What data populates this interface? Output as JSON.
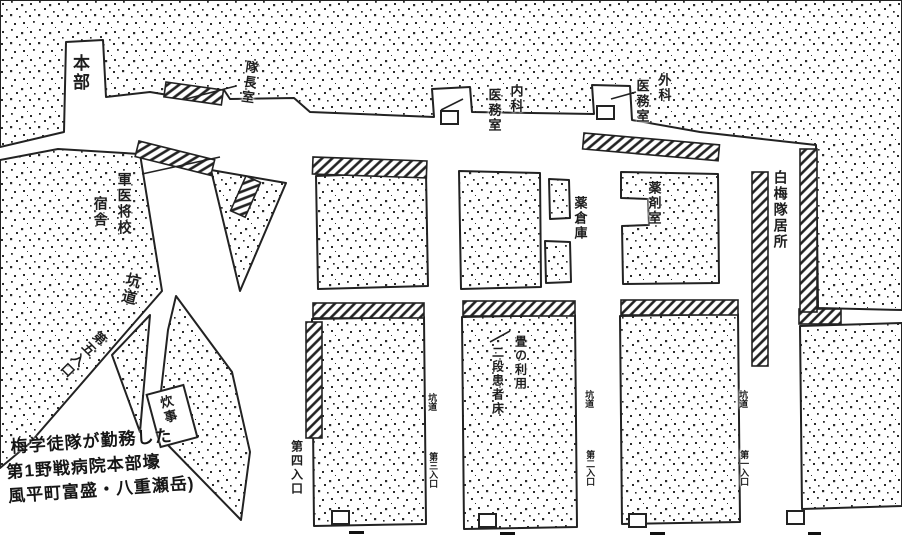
{
  "map": {
    "type": "hand-drawn tunnel floor plan of a field hospital",
    "colors": {
      "ink": "#222222",
      "paper": "#ffffff"
    },
    "labels": {
      "honbu": "本部",
      "taichoshitsu": "隊長室",
      "gun_i_shoko": "軍医将校",
      "shukusha": "宿舎",
      "kodo_main": "坑道",
      "entrance5": "第五入口",
      "entrance4": "第四入口",
      "suiji": "炊事",
      "naika": "内科",
      "naika_imushitsu": "医務室",
      "geka": "外科",
      "geka_imushitsu": "医務室",
      "yakusoko": "薬倉庫",
      "yakuzaishitsu": "薬剤室",
      "shiraume_kyosho": "白梅隊居所",
      "tatami_riyo": "畳の利用",
      "nidan_kanja_sho": "二段患者床",
      "kodo_small_1": "坑道",
      "kodo_small_2": "坑道",
      "kodo_small_3": "坑道",
      "entrance3": "第三入口",
      "entrance2": "第二入口",
      "entrance1": "第一入口"
    },
    "caption": {
      "line1": "梅学徒隊が勤務した",
      "line2": "第1野戦病院本部壕",
      "line3": "風平町富盛・八重瀬岳)"
    }
  }
}
